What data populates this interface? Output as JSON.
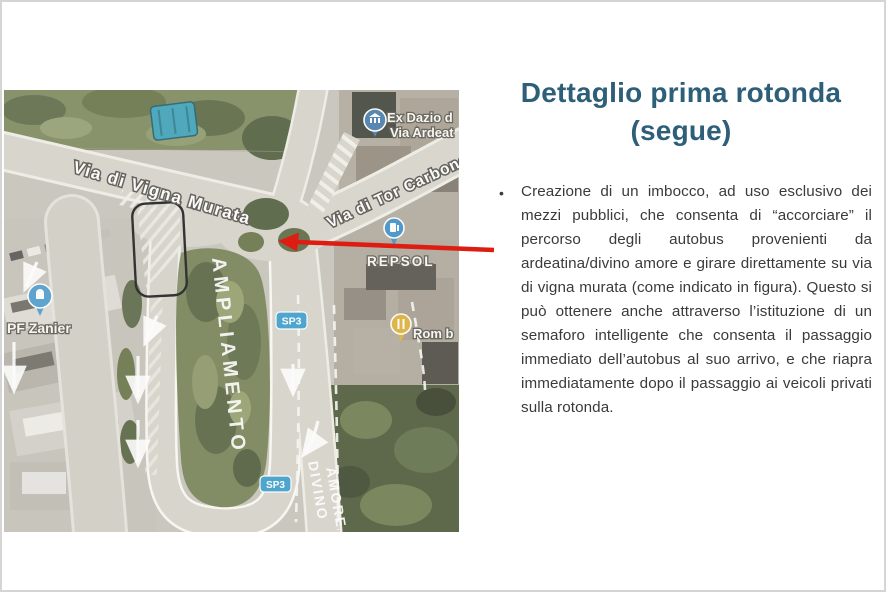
{
  "slide": {
    "title_line1": "Dettaglio prima rotonda",
    "title_line2": "(segue)",
    "bullet": "•",
    "body": "Creazione di un imbocco, ad uso esclusivo dei mezzi pubblici, che consenta di “accorciare” il percorso degli autobus provenienti da ardeatina/divino amore e girare direttamente su via di vigna murata (come indicato in figura). Questo si può ottenere anche attraverso l’istituzione di un semaforo intelligente che consenta il passaggio immediato dell’autobus al suo arrivo, e che riapra immediatamente dopo il passaggio ai veicoli privati sulla rotonda."
  },
  "map": {
    "labels": {
      "vigna_murata": "Via di Vigna Murata",
      "tor_carbone": "Via di Tor Carbone",
      "ex_dazio_1": "Ex Dazio d",
      "ex_dazio_2": "Via Ardeat",
      "repsol": "REPSOL",
      "rom": "Rom b",
      "pf_zanier": "PF Zanier",
      "sp3_top": "SP3",
      "sp3_bottom": "SP3",
      "ampliamento": "AMPLIAMENTO",
      "divino_1": "DIVINO",
      "divino_2": "AMORE"
    }
  },
  "colors": {
    "title_blue": "#2d5f78",
    "body_gray": "#3a3a3a",
    "annotation_red": "#de1d12",
    "badge_blue": "#29a3dd",
    "pin_blue": "#2f93d6",
    "pin_yellow": "#e9b01f",
    "highlight_outline": "#1c1c1c"
  }
}
